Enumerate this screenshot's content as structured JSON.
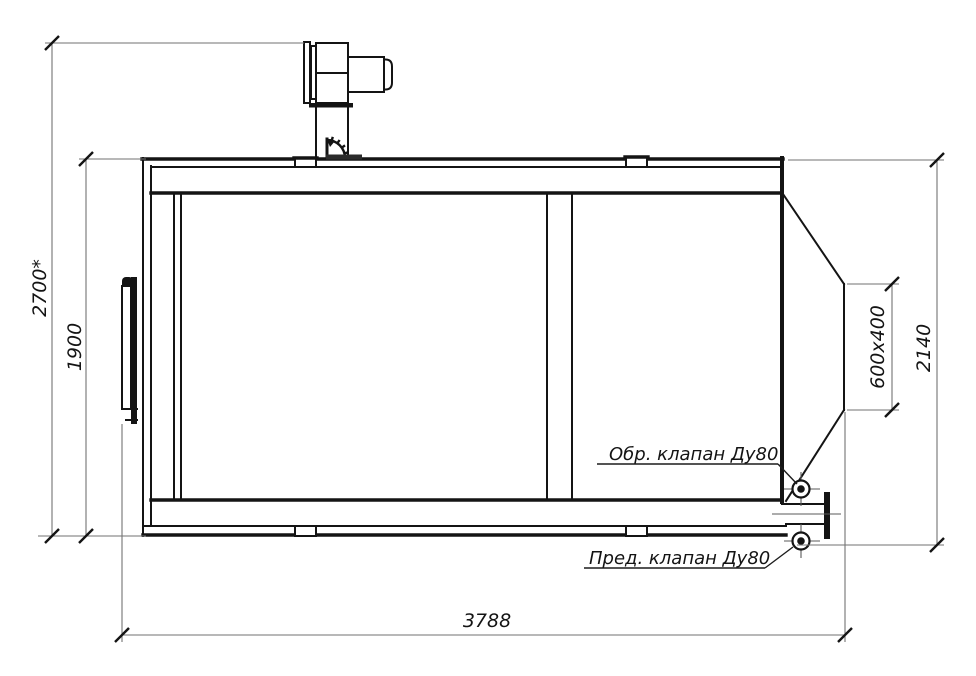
{
  "drawing": {
    "dimensions": {
      "overall_height": "2700*",
      "shell_height": "1900",
      "right_side_height": "2140",
      "outlet_size": "600x400",
      "overall_length": "3788"
    },
    "labels": {
      "check_valve": "Обр. клапан Ду80",
      "safety_valve": "Пред. клапан Ду80"
    },
    "colors": {
      "background": "#ffffff",
      "outline": "#141414",
      "dimension_lines": "#727272"
    }
  }
}
